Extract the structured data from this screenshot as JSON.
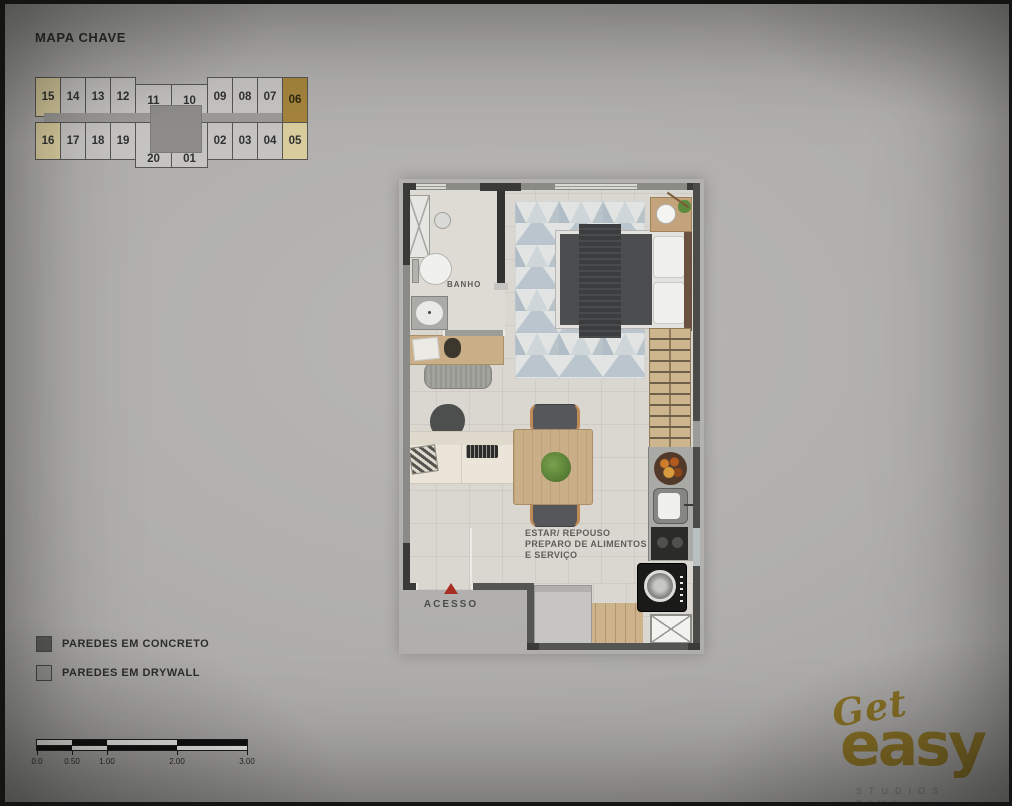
{
  "header": {
    "title": "MAPA CHAVE"
  },
  "keymap": {
    "top_row": [
      {
        "label": "15",
        "style": "beige"
      },
      {
        "label": "14",
        "style": "normal"
      },
      {
        "label": "13",
        "style": "normal"
      },
      {
        "label": "12",
        "style": "normal"
      },
      {
        "label": "11",
        "style": "normal"
      },
      {
        "label": "10",
        "style": "normal"
      },
      {
        "label": "09",
        "style": "normal"
      },
      {
        "label": "08",
        "style": "normal"
      },
      {
        "label": "07",
        "style": "normal"
      },
      {
        "label": "06",
        "style": "gold"
      }
    ],
    "bottom_row": [
      {
        "label": "16",
        "style": "beige"
      },
      {
        "label": "17",
        "style": "normal"
      },
      {
        "label": "18",
        "style": "normal"
      },
      {
        "label": "19",
        "style": "normal"
      },
      {
        "label": "20",
        "style": "normal"
      },
      {
        "label": "01",
        "style": "normal"
      },
      {
        "label": "02",
        "style": "normal"
      },
      {
        "label": "03",
        "style": "normal"
      },
      {
        "label": "04",
        "style": "normal"
      },
      {
        "label": "05",
        "style": "beige"
      }
    ],
    "highlight_colors": {
      "normal": "#c5c4c2",
      "beige": "#d9cc9d",
      "gold": "#a5853c"
    }
  },
  "floorplan": {
    "room_labels": {
      "bathroom": "BANHO",
      "access": "ACESSO"
    },
    "living_label_lines": [
      "ESTAR/ REPOUSO",
      "PREPARO DE ALIMENTOS",
      "E SERVIÇO"
    ],
    "access_marker_color": "#a82e24"
  },
  "legend": {
    "items": [
      {
        "label": "PAREDES EM CONCRETO",
        "color": "#5c5c5a"
      },
      {
        "label": "PAREDES EM DRYWALL",
        "color": "#9a9a96"
      }
    ]
  },
  "scalebar": {
    "labels": [
      "0.0",
      "0.50",
      "1.00",
      "2.00",
      "3.00"
    ]
  },
  "logo": {
    "script_word": "Get",
    "main_word": "easy",
    "subtitle_line1": "STUDIOS",
    "subtitle_line2": "RIVA",
    "color": "#8b7326"
  }
}
